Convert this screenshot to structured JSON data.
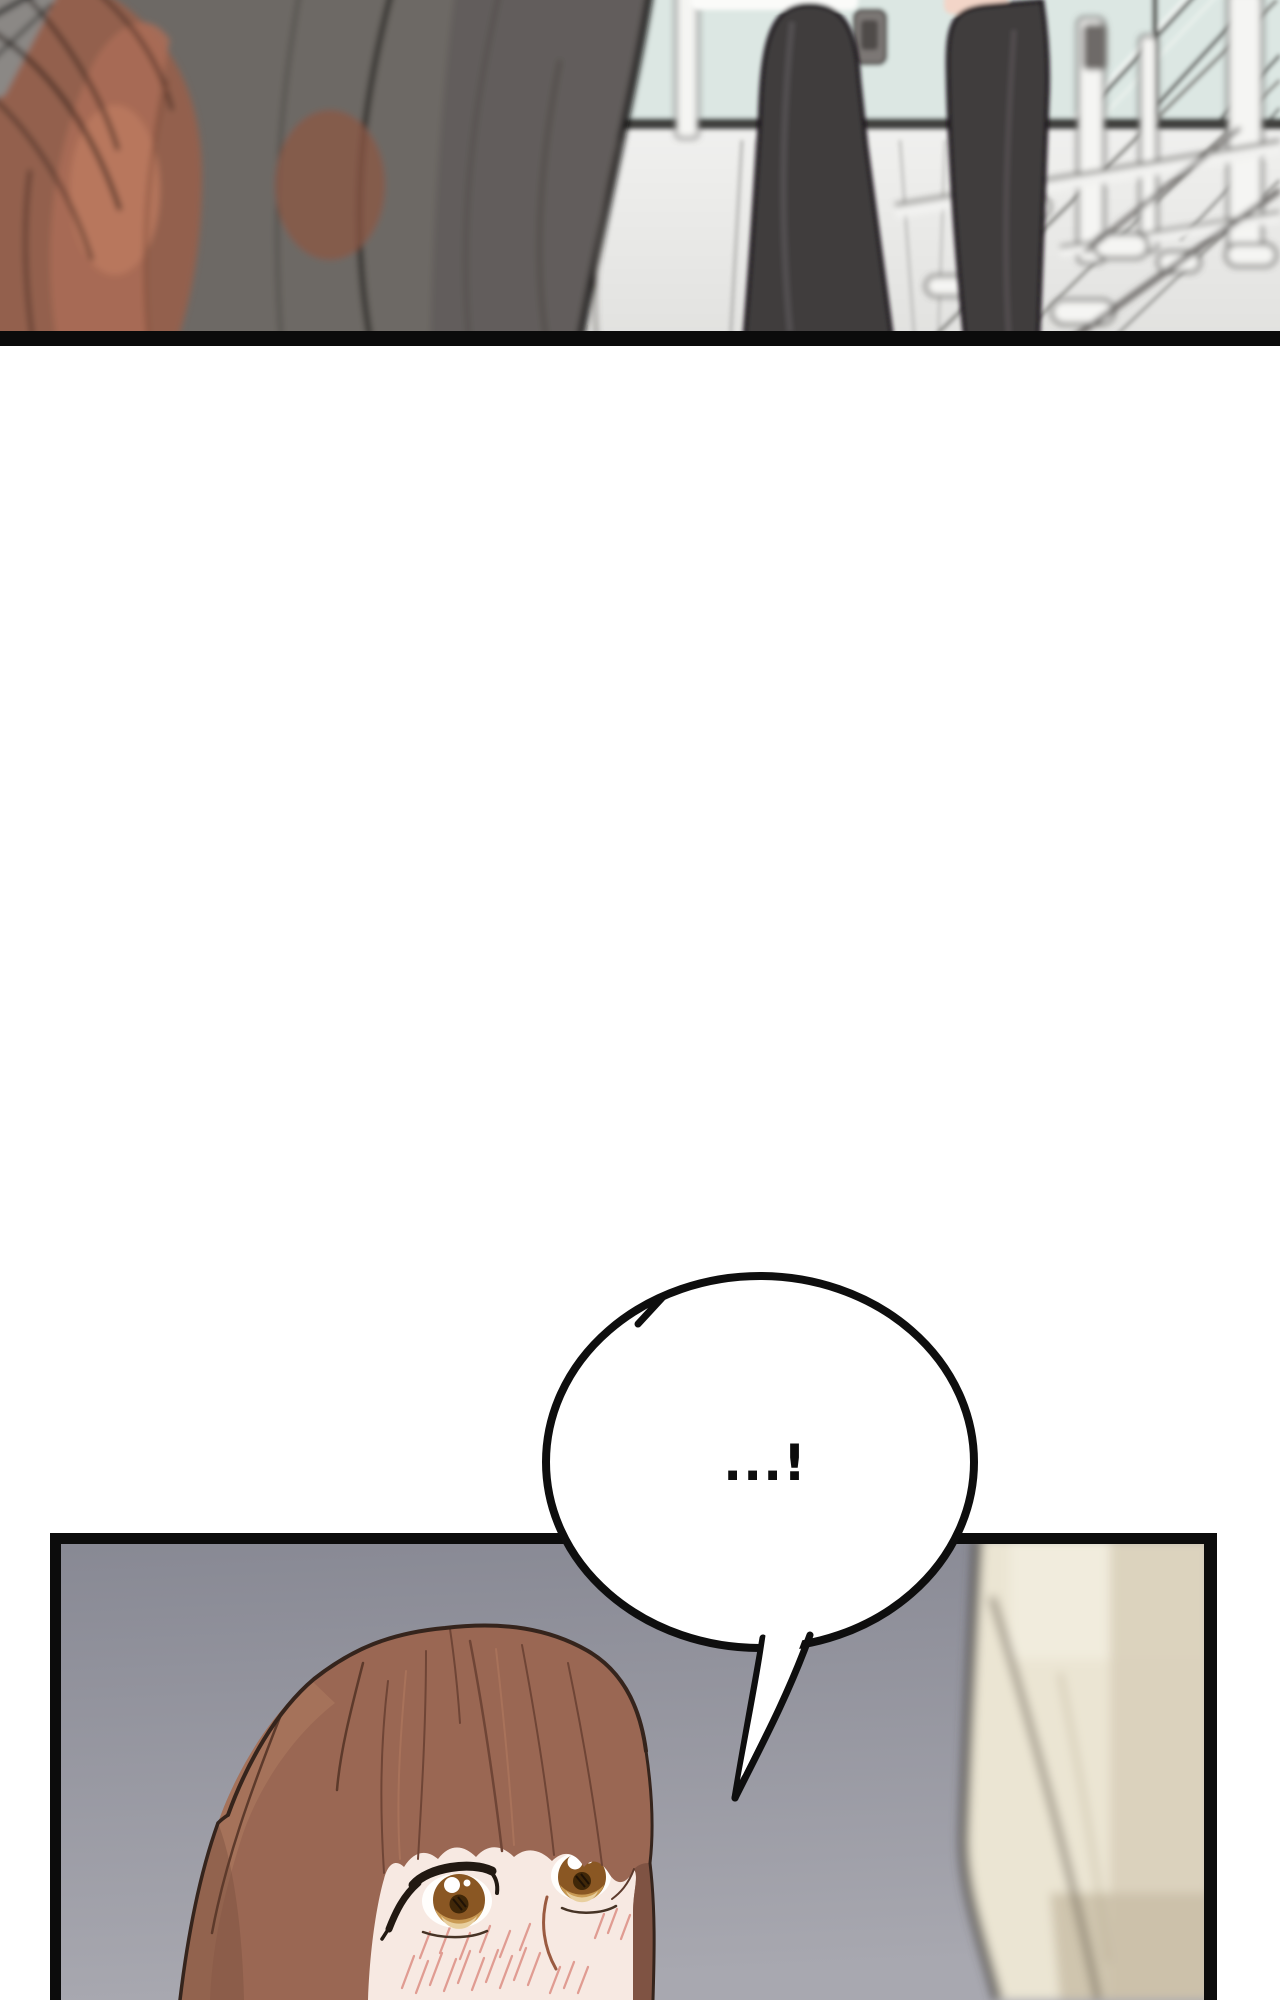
{
  "page": {
    "background": "#ffffff",
    "kind": "webtoon comic segment, two panels with one speech bubble"
  },
  "panels": {
    "top": {
      "alt": "Blurred close-up of red-brown hair and a dark figure in the foreground; behind them two legs in dark tights stand in a bright studio with a mint glass wall and pale reflective floor",
      "border_color": "#0b0b0b"
    },
    "bottom": {
      "alt": "A brown-haired woman with wide amber eyes and blushing cheeks looks up; a blurred beige-coated figure stands at the right edge",
      "border_color": "#0c0c0c",
      "background_top": "#878893",
      "background_bottom": "#a8a8b0"
    }
  },
  "speech_bubble": {
    "text": "...!",
    "fill": "#ffffff",
    "outline": "#0e0e0e"
  },
  "colors": {
    "hair_foreground": "#93604e",
    "hair_foreground_highlight": "#bd7a5f",
    "dark_mass": "#6d6965",
    "wall_mint": "#dce7e3",
    "wall_band": "#434341",
    "floor_light": "#f0f0ee",
    "floor_dark": "#e1e1df",
    "legs": "#403c3e",
    "leg_skin": "#f3d5c8",
    "woman_hair": "#9a6753",
    "woman_hair_shadow": "#7c5141",
    "woman_hair_light": "#a8765c",
    "woman_skin": "#f7e9e2",
    "iris": "#8a5723",
    "iris_light": "#e8cf9f",
    "blush": "#df988e",
    "coat_beige": "#ebe5d3",
    "coat_shadow": "#d8cfb9"
  }
}
